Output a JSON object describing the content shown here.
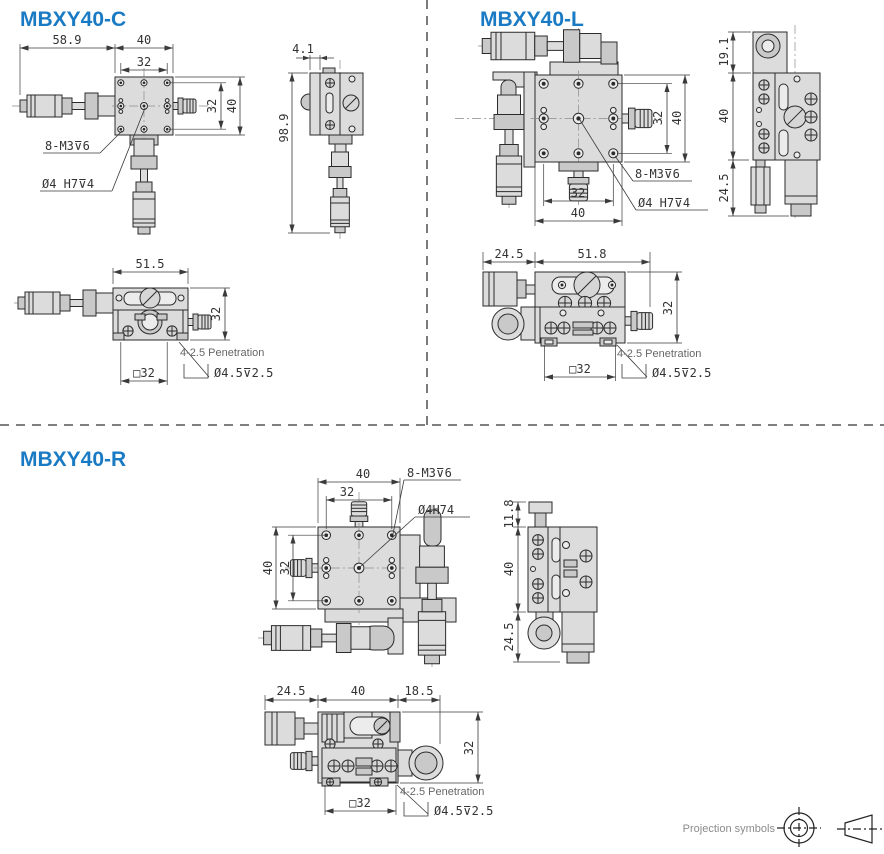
{
  "sections": {
    "c": {
      "title": "MBXY40-C",
      "front": {
        "dim_overall": "58.9",
        "dim_plate": "40",
        "dim_holes": "32",
        "dim_holes_v": "32",
        "dim_plate_v": "40",
        "note_holes": "8-M3⊽6",
        "note_center": "Ø4 H7⊽4"
      },
      "side": {
        "dim_top": "4.1",
        "dim_height": "98.9"
      },
      "bottom": {
        "dim_width": "51.5",
        "dim_height": "32",
        "dim_square": "□32",
        "note_penetration": "4-2.5 Penetration",
        "note_counterbore": "Ø4.5⊽2.5"
      }
    },
    "l": {
      "title": "MBXY40-L",
      "front": {
        "dim_holes_v": "32",
        "dim_plate_v": "40",
        "dim_holes": "32",
        "dim_plate": "40",
        "note_holes": "8-M3⊽6",
        "note_center": "Ø4 H7⊽4"
      },
      "side": {
        "dim_top": "19.1",
        "dim_mid": "40",
        "dim_bottom": "24.5"
      },
      "bottom": {
        "dim_left": "24.5",
        "dim_width": "51.8",
        "dim_height": "32",
        "dim_square": "□32",
        "note_penetration": "4-2.5 Penetration",
        "note_counterbore": "Ø4.5⊽2.5"
      }
    },
    "r": {
      "title": "MBXY40-R",
      "front": {
        "dim_plate": "40",
        "dim_holes": "32",
        "dim_plate_v": "40",
        "dim_holes_v": "32",
        "note_holes": "8-M3⊽6",
        "note_center": "Ø4H74"
      },
      "side": {
        "dim_top": "11.8",
        "dim_mid": "40",
        "dim_bottom": "24.5"
      },
      "bottom": {
        "dim_left": "24.5",
        "dim_mid": "40",
        "dim_right": "18.5",
        "dim_height": "32",
        "dim_square": "□32",
        "note_penetration": "4-2.5 Penetration",
        "note_counterbore": "Ø4.5⊽2.5"
      }
    }
  },
  "footer": {
    "projection_label": "Projection symbols"
  }
}
